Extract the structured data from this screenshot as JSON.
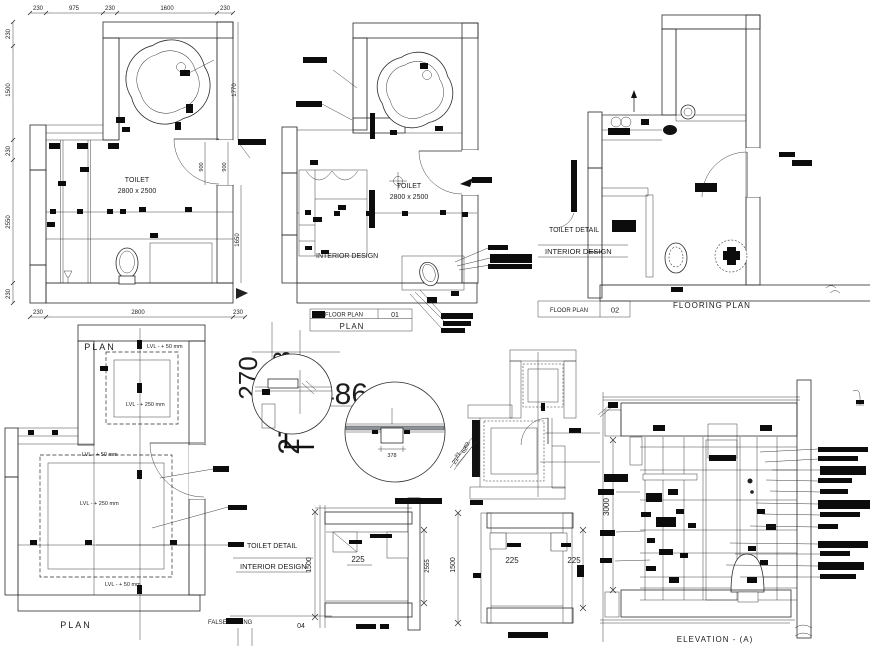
{
  "sheet": {
    "background": "#ffffff",
    "ink": "#1f1f1f"
  },
  "plan1": {
    "title": "PLAN",
    "room": "TOILET",
    "size": "2800 x 2500",
    "top": [
      "230",
      "975",
      "230",
      "1600",
      "230"
    ],
    "left": [
      "230",
      "1500",
      "230",
      "2550",
      "230"
    ],
    "bottom": [
      "230",
      "2800",
      "230"
    ],
    "right_tub": "1770",
    "right_room": "1650",
    "door_a": "900",
    "door_b": "900"
  },
  "plan2": {
    "title": "PLAN",
    "room": "TOILET",
    "size": "2800 x 2500",
    "interior": "INTERIOR DESIGN",
    "block_label": "FLOOR PLAN",
    "block_no": "01"
  },
  "plan3": {
    "caption": "FLOORING PLAN",
    "side1": "TOILET DETAIL",
    "side2": "INTERIOR DESIGN",
    "block_label": "FLOOR PLAN",
    "block_no": "02"
  },
  "plan4": {
    "title": "PLAN",
    "lvl50": "LVL - + 50 mm",
    "lvl250": "LVL - + 250 mm",
    "side1": "TOILET DETAIL",
    "side2": "INTERIOR DESIGN",
    "false_ceiling": "FALSE CEILING",
    "sheet_no": "04"
  },
  "center": {
    "n270": "270",
    "n808": "808",
    "n304": "304",
    "n486": "486",
    "n27": "27",
    "d378": "378",
    "d21": "21",
    "d62": "62"
  },
  "sections": {
    "s1": {
      "height": "1500",
      "shelf": "225",
      "right": "2555"
    },
    "s2": {
      "height": "1500",
      "shelf_a": "225",
      "shelf_b": "225"
    }
  },
  "elevation": {
    "caption": "ELEVATION - (A)",
    "height": "3000"
  }
}
